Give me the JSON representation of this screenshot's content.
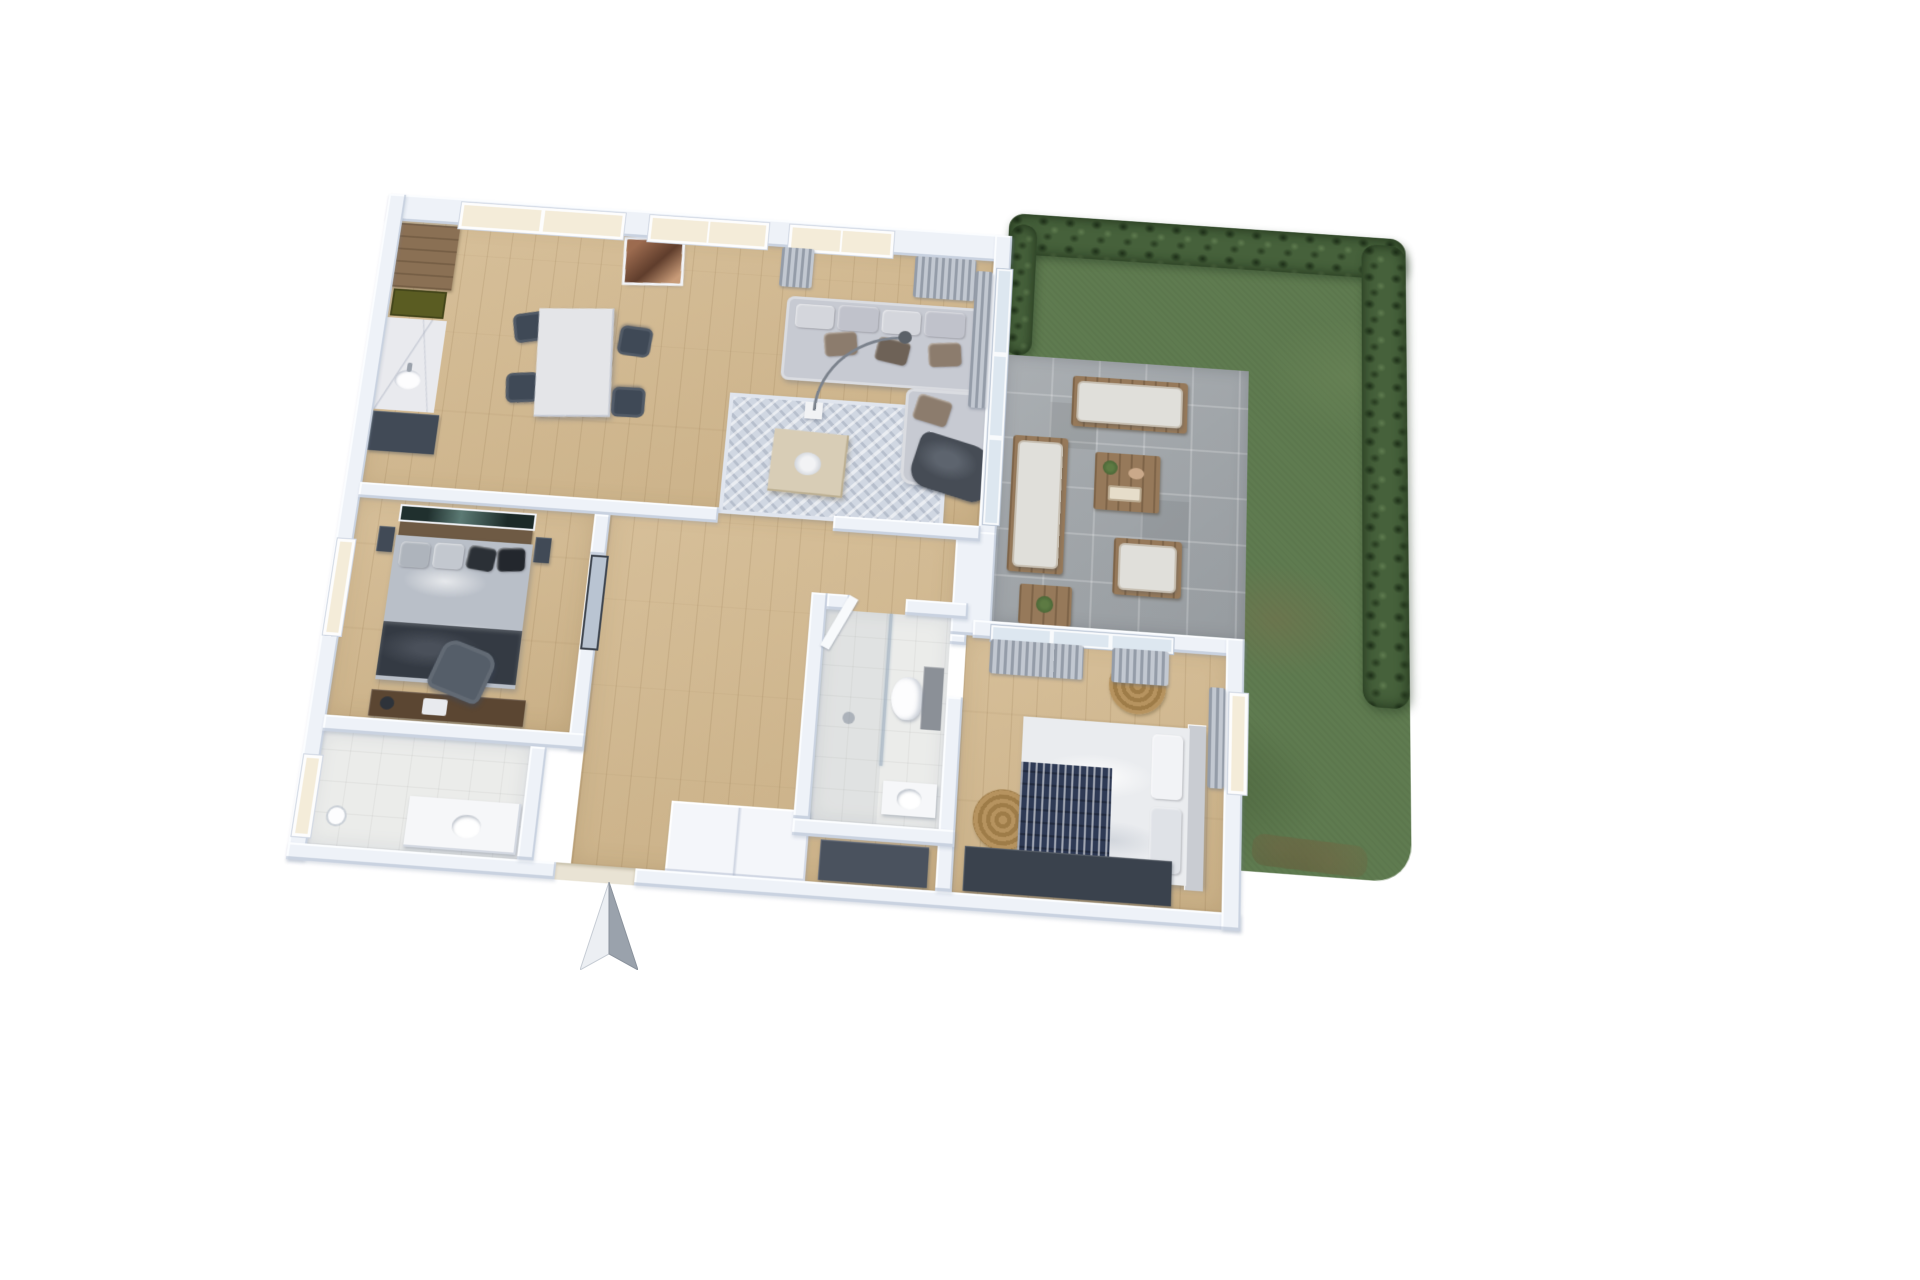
{
  "meta": {
    "scene": "3D rendered floor plan of an apartment with garden, top-down axonometric view",
    "background": "#ffffff"
  },
  "compass": {
    "icon": "north-arrow-icon",
    "direction": "north",
    "light": "#eceff3",
    "dark": "#9aa2ac"
  },
  "palette": {
    "wall": "#eef2f8",
    "wood_floor": "#d2b88e",
    "tile_floor": "#ebecea",
    "terrace_paving": "#a3a8ac",
    "lawn": "#5f7b50",
    "hedge": "#46613b",
    "sofa": "#c7cad2",
    "dark_furniture": "#3f4956",
    "window_glass": "#f4ecd9",
    "door_glass": "#dde7f0",
    "navy_blanket": "#2e3a55",
    "round_rug": "#b6935f",
    "kitchen_wood": "#8a7054",
    "marble": "#e9eaee",
    "copper_art": "#9c6b4f"
  },
  "rooms": [
    {
      "id": "living",
      "name": "Open living room with kitchen and dining area"
    },
    {
      "id": "bedroom1",
      "name": "Bedroom 1 with double bed and desk"
    },
    {
      "id": "bedroom2",
      "name": "Bedroom 2 with double bed"
    },
    {
      "id": "bathroom",
      "name": "Bathroom with shower, toilet and washbasin"
    },
    {
      "id": "bathroom2",
      "name": "Second bathroom / laundry room"
    },
    {
      "id": "hallway",
      "name": "Hallway"
    },
    {
      "id": "entrance",
      "name": "Entrance with wardrobe"
    },
    {
      "id": "terrace",
      "name": "Paved terrace with outdoor lounge set"
    },
    {
      "id": "garden",
      "name": "Garden with lawn and hedges"
    }
  ],
  "furniture": {
    "living": [
      "kitchen tall cabinet",
      "cooktop",
      "marble counter with sink",
      "kitchen base unit",
      "dining table",
      "four dining chairs",
      "copper wall art",
      "corner sofa with pillows",
      "throw blanket",
      "area rug",
      "beige ottoman with tray",
      "arc floor lamp",
      "curtains"
    ],
    "bedroom1": [
      "double bed with dark bedding",
      "wall art",
      "two nightstands",
      "desk",
      "office chair",
      "glass door"
    ],
    "bedroom2": [
      "double bed with white duvet and navy blanket",
      "headboard",
      "two round woven rugs",
      "dark wardrobe",
      "curtains"
    ],
    "bathroom": [
      "shower with glass screen",
      "wall-hung toilet",
      "washbasin",
      "open door"
    ],
    "bathroom2": [
      "vanity with sink",
      "floor lamp"
    ],
    "terrace": [
      "two outdoor sofas",
      "outdoor armchair",
      "wooden coffee table",
      "side table with plant"
    ],
    "entrance": [
      "built-in wardrobe"
    ]
  }
}
